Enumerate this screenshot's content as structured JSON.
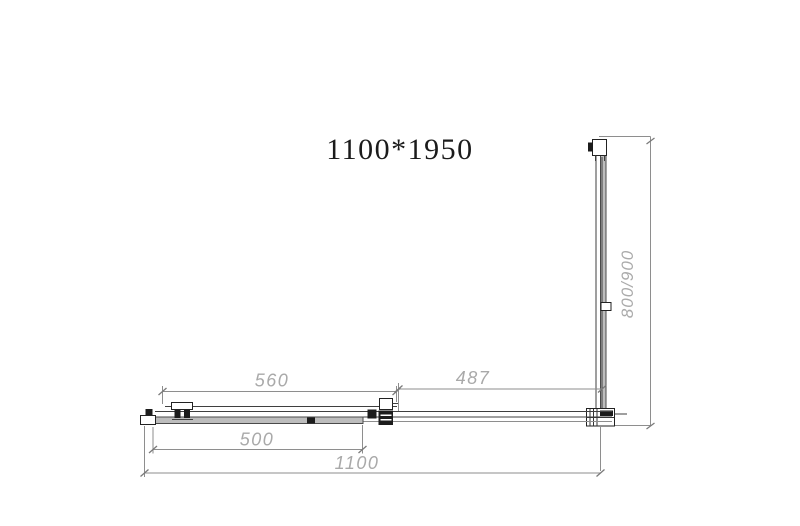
{
  "drawing": {
    "title": "1100*1950",
    "dims": {
      "slider_top": "560",
      "fixed_top": "487",
      "opening": "500",
      "overall": "1100",
      "side": "800/900"
    },
    "colors": {
      "line": "#3f3f3f",
      "dim_line": "#8e8e8e",
      "dim_text": "#a9a9a9",
      "glass_band": "#bdbdbd",
      "title_text": "#1b1b1b",
      "background": "#ffffff"
    }
  }
}
